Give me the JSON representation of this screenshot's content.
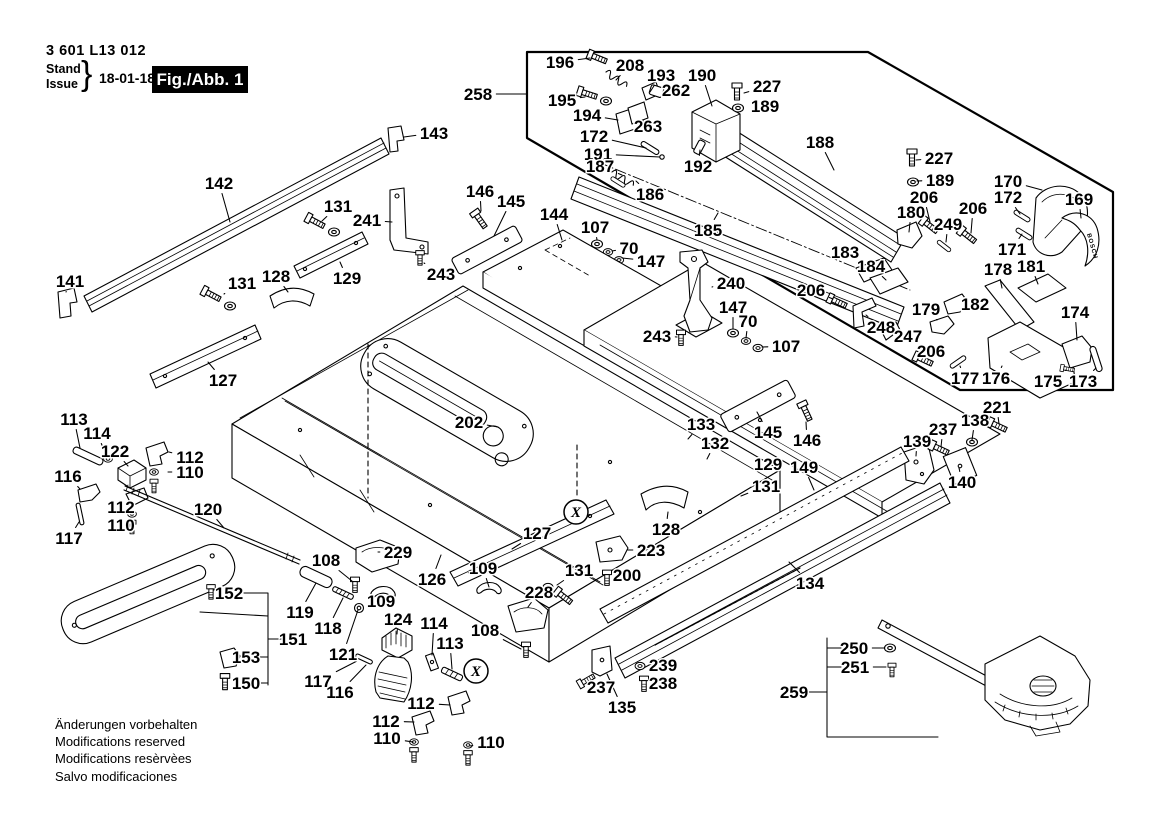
{
  "header": {
    "part_number": "3 601 L13 012",
    "stand": "Stand",
    "issue": "Issue",
    "brace": "}",
    "date": "18-01-18",
    "figure_label": "Fig./Abb. 1"
  },
  "footer": {
    "lines": [
      "Änderungen vorbehalten",
      "Modifications reserved",
      "Modifications resèrvèes",
      "Salvo modificaciones"
    ]
  },
  "brand_text": "BOSCH",
  "inset": {
    "label": "258"
  },
  "circled_marks": [
    {
      "label": "X",
      "x": 576,
      "y": 512
    },
    {
      "label": "X",
      "x": 476,
      "y": 671
    }
  ],
  "callouts": [
    {
      "t": "258",
      "x": 478,
      "y": 94,
      "tx": 526,
      "ty": 94
    },
    {
      "t": "196",
      "x": 560,
      "y": 62,
      "tx": 590,
      "ty": 58
    },
    {
      "t": "208",
      "x": 630,
      "y": 65,
      "tx": 616,
      "ty": 80
    },
    {
      "t": "193",
      "x": 661,
      "y": 75,
      "tx": 650,
      "ty": 92
    },
    {
      "t": "190",
      "x": 702,
      "y": 75,
      "tx": 712,
      "ty": 106
    },
    {
      "t": "227",
      "x": 767,
      "y": 86,
      "tx": 744,
      "ty": 93
    },
    {
      "t": "189",
      "x": 765,
      "y": 106,
      "tx": 748,
      "ty": 107
    },
    {
      "t": "262",
      "x": 676,
      "y": 90,
      "tx": 661,
      "ty": 92
    },
    {
      "t": "195",
      "x": 562,
      "y": 100,
      "tx": 585,
      "ty": 97
    },
    {
      "t": "194",
      "x": 587,
      "y": 115,
      "tx": 618,
      "ty": 120
    },
    {
      "t": "263",
      "x": 648,
      "y": 126,
      "tx": 640,
      "ty": 116
    },
    {
      "t": "172",
      "x": 594,
      "y": 136,
      "tx": 646,
      "ty": 148
    },
    {
      "t": "191",
      "x": 598,
      "y": 154,
      "tx": 660,
      "ty": 157
    },
    {
      "t": "187",
      "x": 600,
      "y": 166,
      "tx": 622,
      "ty": 175
    },
    {
      "t": "186",
      "x": 650,
      "y": 194,
      "tx": 636,
      "ty": 181
    },
    {
      "t": "185",
      "x": 708,
      "y": 230,
      "tx": 718,
      "ty": 213
    },
    {
      "t": "188",
      "x": 820,
      "y": 142,
      "tx": 834,
      "ty": 170
    },
    {
      "t": "192",
      "x": 698,
      "y": 166,
      "tx": 700,
      "ty": 150
    },
    {
      "t": "227",
      "x": 939,
      "y": 158,
      "tx": 916,
      "ty": 160
    },
    {
      "t": "189",
      "x": 940,
      "y": 180,
      "tx": 917,
      "ty": 181
    },
    {
      "t": "206",
      "x": 924,
      "y": 197,
      "tx": 930,
      "ty": 222
    },
    {
      "t": "180",
      "x": 911,
      "y": 212,
      "tx": 909,
      "ty": 232
    },
    {
      "t": "249",
      "x": 948,
      "y": 224,
      "tx": 946,
      "ty": 242
    },
    {
      "t": "206",
      "x": 973,
      "y": 208,
      "tx": 971,
      "ty": 233
    },
    {
      "t": "170",
      "x": 1008,
      "y": 181,
      "tx": 1042,
      "ty": 190
    },
    {
      "t": "172",
      "x": 1008,
      "y": 197,
      "tx": 1020,
      "ty": 214
    },
    {
      "t": "169",
      "x": 1079,
      "y": 199,
      "tx": 1081,
      "ty": 218
    },
    {
      "t": "171",
      "x": 1012,
      "y": 249,
      "tx": 1022,
      "ty": 234
    },
    {
      "t": "183",
      "x": 845,
      "y": 252,
      "tx": 868,
      "ty": 272
    },
    {
      "t": "184",
      "x": 871,
      "y": 266,
      "tx": 886,
      "ty": 280
    },
    {
      "t": "178",
      "x": 998,
      "y": 269,
      "tx": 1002,
      "ty": 288
    },
    {
      "t": "181",
      "x": 1031,
      "y": 266,
      "tx": 1038,
      "ty": 284
    },
    {
      "t": "182",
      "x": 975,
      "y": 304,
      "tx": 960,
      "ty": 305
    },
    {
      "t": "179",
      "x": 926,
      "y": 309,
      "tx": 937,
      "ty": 320
    },
    {
      "t": "248",
      "x": 881,
      "y": 327,
      "tx": 866,
      "ty": 315
    },
    {
      "t": "247",
      "x": 908,
      "y": 336,
      "tx": 894,
      "ty": 331
    },
    {
      "t": "206",
      "x": 931,
      "y": 351,
      "tx": 926,
      "ty": 358
    },
    {
      "t": "174",
      "x": 1075,
      "y": 312,
      "tx": 1077,
      "ty": 340
    },
    {
      "t": "177",
      "x": 965,
      "y": 378,
      "tx": 960,
      "ty": 366
    },
    {
      "t": "176",
      "x": 996,
      "y": 378,
      "tx": 1002,
      "ty": 366
    },
    {
      "t": "175",
      "x": 1048,
      "y": 381,
      "tx": 1066,
      "ty": 370
    },
    {
      "t": "173",
      "x": 1083,
      "y": 381,
      "tx": 1096,
      "ty": 368
    },
    {
      "t": "143",
      "x": 434,
      "y": 133,
      "tx": 404,
      "ty": 137
    },
    {
      "t": "142",
      "x": 219,
      "y": 183,
      "tx": 230,
      "ty": 222
    },
    {
      "t": "131",
      "x": 338,
      "y": 206,
      "tx": 322,
      "ty": 221
    },
    {
      "t": "241",
      "x": 367,
      "y": 220,
      "tx": 392,
      "ty": 222
    },
    {
      "t": "243",
      "x": 441,
      "y": 274,
      "tx": 424,
      "ty": 263
    },
    {
      "t": "146",
      "x": 480,
      "y": 191,
      "tx": 481,
      "ty": 211
    },
    {
      "t": "145",
      "x": 511,
      "y": 201,
      "tx": 494,
      "ty": 236
    },
    {
      "t": "144",
      "x": 554,
      "y": 214,
      "tx": 562,
      "ty": 240
    },
    {
      "t": "107",
      "x": 595,
      "y": 227,
      "tx": 597,
      "ty": 240
    },
    {
      "t": "70",
      "x": 629,
      "y": 248,
      "tx": 612,
      "ty": 251
    },
    {
      "t": "147",
      "x": 651,
      "y": 261,
      "tx": 622,
      "ty": 258
    },
    {
      "t": "128",
      "x": 276,
      "y": 276,
      "tx": 288,
      "ty": 292
    },
    {
      "t": "129",
      "x": 347,
      "y": 278,
      "tx": 340,
      "ty": 262
    },
    {
      "t": "131",
      "x": 242,
      "y": 283,
      "tx": 224,
      "ty": 294
    },
    {
      "t": "141",
      "x": 70,
      "y": 281,
      "tx": 66,
      "ty": 292
    },
    {
      "t": "127",
      "x": 223,
      "y": 380,
      "tx": 208,
      "ty": 362
    },
    {
      "t": "240",
      "x": 731,
      "y": 283,
      "tx": 712,
      "ty": 287
    },
    {
      "t": "147",
      "x": 733,
      "y": 307,
      "tx": 733,
      "ty": 329
    },
    {
      "t": "70",
      "x": 748,
      "y": 321,
      "tx": 746,
      "ty": 338
    },
    {
      "t": "107",
      "x": 786,
      "y": 346,
      "tx": 762,
      "ty": 347
    },
    {
      "t": "243",
      "x": 657,
      "y": 336,
      "tx": 677,
      "ty": 337
    },
    {
      "t": "206",
      "x": 811,
      "y": 290,
      "tx": 833,
      "ty": 299
    },
    {
      "t": "202",
      "x": 469,
      "y": 422,
      "tx": 498,
      "ty": 427
    },
    {
      "t": "113",
      "x": 74,
      "y": 419,
      "tx": 80,
      "ty": 448
    },
    {
      "t": "114",
      "x": 97,
      "y": 433,
      "tx": 106,
      "ty": 455
    },
    {
      "t": "122",
      "x": 115,
      "y": 451,
      "tx": 128,
      "ty": 466
    },
    {
      "t": "116",
      "x": 68,
      "y": 476,
      "tx": 80,
      "ty": 489
    },
    {
      "t": "112",
      "x": 190,
      "y": 457,
      "tx": 169,
      "ty": 452
    },
    {
      "t": "110",
      "x": 190,
      "y": 472,
      "tx": 168,
      "ty": 472
    },
    {
      "t": "112",
      "x": 121,
      "y": 507,
      "tx": 134,
      "ty": 500
    },
    {
      "t": "110",
      "x": 121,
      "y": 525,
      "tx": 134,
      "ty": 520
    },
    {
      "t": "117",
      "x": 69,
      "y": 538,
      "tx": 79,
      "ty": 522
    },
    {
      "t": "120",
      "x": 208,
      "y": 509,
      "tx": 224,
      "ty": 528
    },
    {
      "t": "108",
      "x": 326,
      "y": 560,
      "tx": 352,
      "ty": 581
    },
    {
      "t": "229",
      "x": 398,
      "y": 552,
      "tx": 378,
      "ty": 552
    },
    {
      "t": "109",
      "x": 381,
      "y": 601,
      "tx": 388,
      "ty": 594
    },
    {
      "t": "119",
      "x": 300,
      "y": 612,
      "tx": 316,
      "ty": 583
    },
    {
      "t": "118",
      "x": 328,
      "y": 628,
      "tx": 343,
      "ty": 598
    },
    {
      "t": "121",
      "x": 343,
      "y": 654,
      "tx": 358,
      "ty": 610
    },
    {
      "t": "124",
      "x": 398,
      "y": 619,
      "tx": 397,
      "ty": 634
    },
    {
      "t": "114",
      "x": 434,
      "y": 623,
      "tx": 432,
      "ty": 655
    },
    {
      "t": "113",
      "x": 450,
      "y": 643,
      "tx": 452,
      "ty": 669
    },
    {
      "t": "117",
      "x": 318,
      "y": 681,
      "tx": 357,
      "ty": 661
    },
    {
      "t": "116",
      "x": 340,
      "y": 692,
      "tx": 366,
      "ty": 665
    },
    {
      "t": "112",
      "x": 421,
      "y": 703,
      "tx": 450,
      "ty": 705
    },
    {
      "t": "112",
      "x": 386,
      "y": 721,
      "tx": 414,
      "ty": 722
    },
    {
      "t": "110",
      "x": 387,
      "y": 738,
      "tx": 413,
      "ty": 742
    },
    {
      "t": "110",
      "x": 491,
      "y": 742,
      "tx": 470,
      "ty": 746
    },
    {
      "t": "152",
      "x": 229,
      "y": 593,
      "tx": 216,
      "ty": 594
    },
    {
      "t": "151",
      "x": 293,
      "y": 639
    },
    {
      "t": "153",
      "x": 246,
      "y": 657,
      "tx": 232,
      "ty": 658
    },
    {
      "t": "150",
      "x": 246,
      "y": 683,
      "tx": 229,
      "ty": 681
    },
    {
      "t": "126",
      "x": 432,
      "y": 579,
      "tx": 441,
      "ty": 555
    },
    {
      "t": "127",
      "x": 537,
      "y": 533,
      "tx": 512,
      "ty": 549
    },
    {
      "t": "223",
      "x": 651,
      "y": 550,
      "tx": 628,
      "ty": 550
    },
    {
      "t": "200",
      "x": 627,
      "y": 575,
      "tx": 613,
      "ty": 578
    },
    {
      "t": "131",
      "x": 579,
      "y": 570,
      "tx": 557,
      "ty": 585
    },
    {
      "t": "109",
      "x": 483,
      "y": 568,
      "tx": 489,
      "ty": 587
    },
    {
      "t": "228",
      "x": 539,
      "y": 592,
      "tx": 528,
      "ty": 607
    },
    {
      "t": "108",
      "x": 485,
      "y": 630,
      "tx": 521,
      "ty": 649
    },
    {
      "t": "128",
      "x": 666,
      "y": 529,
      "tx": 668,
      "ty": 512
    },
    {
      "t": "133",
      "x": 701,
      "y": 424,
      "tx": 688,
      "ty": 439
    },
    {
      "t": "132",
      "x": 715,
      "y": 443,
      "tx": 707,
      "ty": 459
    },
    {
      "t": "145",
      "x": 768,
      "y": 432,
      "tx": 757,
      "ty": 412
    },
    {
      "t": "146",
      "x": 807,
      "y": 440,
      "tx": 806,
      "ty": 422
    },
    {
      "t": "129",
      "x": 768,
      "y": 464,
      "tx": 750,
      "ty": 468
    },
    {
      "t": "131",
      "x": 766,
      "y": 486,
      "tx": 741,
      "ty": 496
    },
    {
      "t": "149",
      "x": 804,
      "y": 467,
      "tx": 814,
      "ty": 490
    },
    {
      "t": "134",
      "x": 810,
      "y": 583,
      "tx": 789,
      "ty": 562
    },
    {
      "t": "237",
      "x": 601,
      "y": 687,
      "tx": 592,
      "ty": 679
    },
    {
      "t": "135",
      "x": 622,
      "y": 707,
      "tx": 607,
      "ty": 674
    },
    {
      "t": "239",
      "x": 663,
      "y": 665,
      "tx": 647,
      "ty": 666
    },
    {
      "t": "238",
      "x": 663,
      "y": 683,
      "tx": 651,
      "ty": 683
    },
    {
      "t": "139",
      "x": 917,
      "y": 441,
      "tx": 916,
      "ty": 456
    },
    {
      "t": "237",
      "x": 943,
      "y": 429,
      "tx": 941,
      "ty": 447
    },
    {
      "t": "138",
      "x": 975,
      "y": 420,
      "tx": 972,
      "ty": 440
    },
    {
      "t": "221",
      "x": 997,
      "y": 407,
      "tx": 999,
      "ty": 424
    },
    {
      "t": "140",
      "x": 962,
      "y": 482,
      "tx": 959,
      "ty": 468
    },
    {
      "t": "250",
      "x": 854,
      "y": 648,
      "tx": 884,
      "ty": 648
    },
    {
      "t": "251",
      "x": 855,
      "y": 667,
      "tx": 886,
      "ty": 667
    },
    {
      "t": "259",
      "x": 794,
      "y": 692
    }
  ]
}
